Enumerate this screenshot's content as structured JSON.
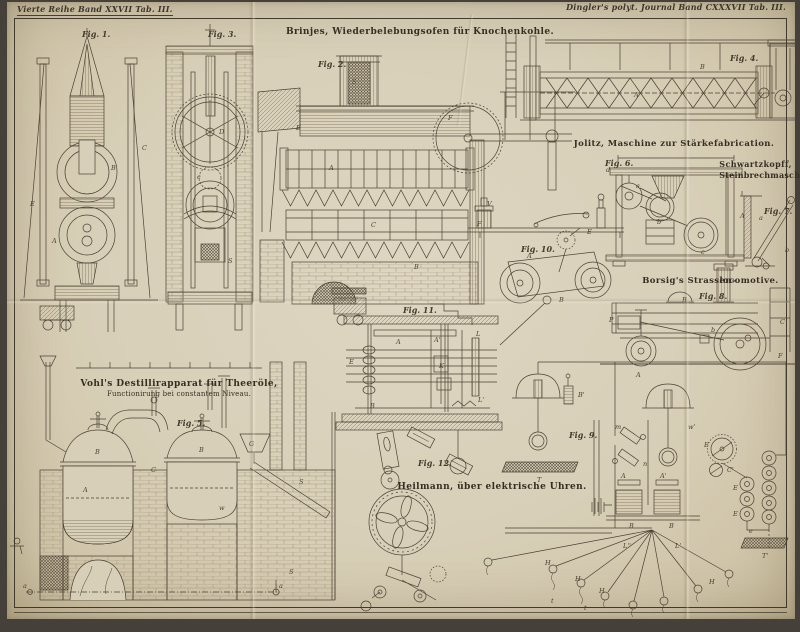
{
  "page": {
    "header_left": "Vierte Reihe Band XXVII Tab. III.",
    "header_right": "Dingler's polyt. Journal Band CXXXVII Tab. III."
  },
  "colors": {
    "paper": "#d8cfb8",
    "ink": "#4b4134",
    "caption": "#362e22"
  },
  "captions": {
    "brinjes": "Brinjes, Wiederbelebungsofen für Knochenkohle.",
    "jolitz": "Jolitz, Maschine zur Stärkefabrication.",
    "schwartzkopff_1": "Schwartzkopff,",
    "schwartzkopff_2": "Steinbrechmaschine",
    "borsig_1": "Borsig's Strassen-",
    "borsig_2": "locomotive.",
    "vohl_1": "Vohl's Destillirapparat für Theeröle,",
    "vohl_2": "Functionirung bei constantem Niveau.",
    "heilmann": "Heilmann, über elektrische Uhren."
  },
  "figures": {
    "fig1": "Fig. 1.",
    "fig2": "Fig. 2.",
    "fig3": "Fig. 3.",
    "fig4": "Fig. 4.",
    "fig5": "Fig. 5.",
    "fig6": "Fig. 6.",
    "fig7": "Fig. 7.",
    "fig8": "Fig. 8.",
    "fig9": "Fig. 9.",
    "fig10": "Fig. 10.",
    "fig11": "Fig. 11.",
    "fig12": "Fig. 12."
  },
  "part_labels": [
    {
      "t": "A",
      "x": 52,
      "y": 243
    },
    {
      "t": "B",
      "x": 111,
      "y": 170
    },
    {
      "t": "E",
      "x": 30,
      "y": 206
    },
    {
      "t": "C",
      "x": 142,
      "y": 150
    },
    {
      "t": "D",
      "x": 219,
      "y": 134
    },
    {
      "t": "S",
      "x": 228,
      "y": 263
    },
    {
      "t": "c",
      "x": 197,
      "y": 179
    },
    {
      "t": "A",
      "x": 329,
      "y": 170
    },
    {
      "t": "B",
      "x": 414,
      "y": 269
    },
    {
      "t": "C",
      "x": 371,
      "y": 227
    },
    {
      "t": "E",
      "x": 296,
      "y": 130
    },
    {
      "t": "F",
      "x": 448,
      "y": 120
    },
    {
      "t": "S",
      "x": 352,
      "y": 84
    },
    {
      "t": "A",
      "x": 634,
      "y": 97
    },
    {
      "t": "B",
      "x": 700,
      "y": 69
    },
    {
      "t": "a",
      "x": 636,
      "y": 188
    },
    {
      "t": "b",
      "x": 657,
      "y": 224
    },
    {
      "t": "c",
      "x": 701,
      "y": 254
    },
    {
      "t": "d",
      "x": 606,
      "y": 172
    },
    {
      "t": "A",
      "x": 740,
      "y": 218
    },
    {
      "t": "a",
      "x": 759,
      "y": 220
    },
    {
      "t": "b",
      "x": 785,
      "y": 252
    },
    {
      "t": "P",
      "x": 609,
      "y": 322
    },
    {
      "t": "B",
      "x": 682,
      "y": 302
    },
    {
      "t": "C",
      "x": 780,
      "y": 324
    },
    {
      "t": "A",
      "x": 636,
      "y": 377
    },
    {
      "t": "b",
      "x": 711,
      "y": 332
    },
    {
      "t": "V",
      "x": 487,
      "y": 206
    },
    {
      "t": "A",
      "x": 527,
      "y": 258
    },
    {
      "t": "B",
      "x": 559,
      "y": 302
    },
    {
      "t": "E",
      "x": 587,
      "y": 234
    },
    {
      "t": "F",
      "x": 477,
      "y": 226
    },
    {
      "t": "A",
      "x": 396,
      "y": 344
    },
    {
      "t": "A'",
      "x": 434,
      "y": 342
    },
    {
      "t": "B",
      "x": 370,
      "y": 408
    },
    {
      "t": "K",
      "x": 439,
      "y": 368
    },
    {
      "t": "L",
      "x": 476,
      "y": 336
    },
    {
      "t": "L'",
      "x": 478,
      "y": 402
    },
    {
      "t": "E",
      "x": 349,
      "y": 364
    },
    {
      "t": "B",
      "x": 95,
      "y": 454
    },
    {
      "t": "B",
      "x": 199,
      "y": 452
    },
    {
      "t": "A",
      "x": 83,
      "y": 492
    },
    {
      "t": "G",
      "x": 249,
      "y": 446
    },
    {
      "t": "C",
      "x": 151,
      "y": 472
    },
    {
      "t": "S",
      "x": 299,
      "y": 484
    },
    {
      "t": "S",
      "x": 289,
      "y": 574
    },
    {
      "t": "a",
      "x": 23,
      "y": 588
    },
    {
      "t": "a",
      "x": 279,
      "y": 588
    },
    {
      "t": "w",
      "x": 219,
      "y": 510
    },
    {
      "t": "T",
      "x": 537,
      "y": 482
    },
    {
      "t": "B'",
      "x": 578,
      "y": 397
    },
    {
      "t": "F",
      "x": 778,
      "y": 358
    },
    {
      "t": "E",
      "x": 704,
      "y": 447
    },
    {
      "t": "C'",
      "x": 727,
      "y": 472
    },
    {
      "t": "E",
      "x": 733,
      "y": 490
    },
    {
      "t": "E",
      "x": 733,
      "y": 516
    },
    {
      "t": "T'",
      "x": 762,
      "y": 558
    },
    {
      "t": "m",
      "x": 615,
      "y": 429
    },
    {
      "t": "n",
      "x": 643,
      "y": 466
    },
    {
      "t": "A",
      "x": 621,
      "y": 478
    },
    {
      "t": "A'",
      "x": 660,
      "y": 478
    },
    {
      "t": "B",
      "x": 629,
      "y": 528
    },
    {
      "t": "B",
      "x": 669,
      "y": 528
    },
    {
      "t": "H",
      "x": 545,
      "y": 565
    },
    {
      "t": "H",
      "x": 575,
      "y": 581
    },
    {
      "t": "H",
      "x": 599,
      "y": 593
    },
    {
      "t": "H",
      "x": 709,
      "y": 584
    },
    {
      "t": "t",
      "x": 551,
      "y": 603
    },
    {
      "t": "t",
      "x": 584,
      "y": 610
    },
    {
      "t": "L'",
      "x": 675,
      "y": 548
    },
    {
      "t": "L''",
      "x": 623,
      "y": 548
    },
    {
      "t": "e",
      "x": 749,
      "y": 533
    },
    {
      "t": "w'",
      "x": 688,
      "y": 429
    }
  ]
}
